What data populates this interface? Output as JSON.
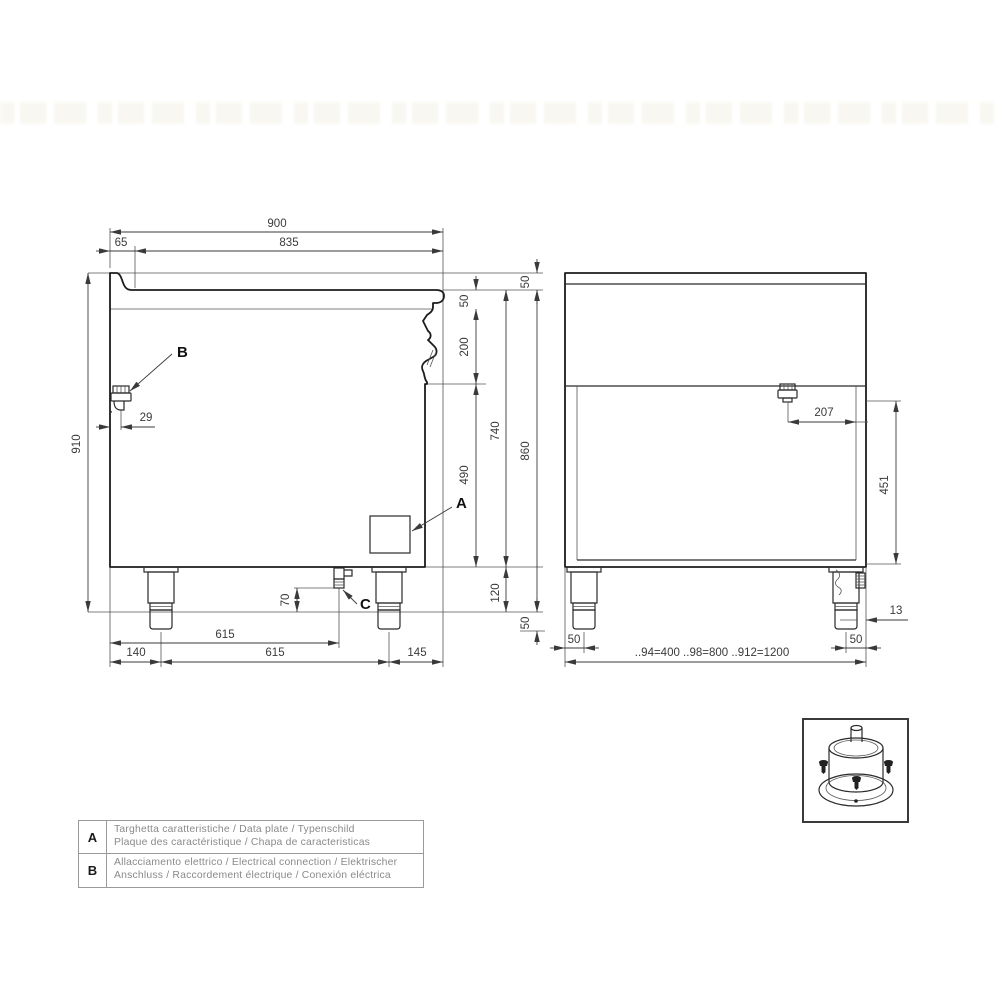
{
  "colors": {
    "background": "#ffffff",
    "line": "#1c1c1c",
    "dim_text": "#3a3a3a",
    "legend_text": "#8a8a8a"
  },
  "side_view": {
    "labels": {
      "data_plate": "A",
      "electrical_gland": "B",
      "drain": "C"
    },
    "dims": {
      "total_width": "900",
      "top_width": "835",
      "left_edge": "65",
      "splash_height": "50",
      "counter_edge": "50",
      "panel_height": "200",
      "body_height": "490",
      "under_top_height": "740",
      "work_height": "860",
      "foot_height": "120",
      "foot_adjust": "50",
      "total_height": "910",
      "gland_offset": "29",
      "drain_height": "70",
      "drain_offset": "615",
      "foot_offset_left": "140",
      "feet_span": "615",
      "foot_offset_right": "145"
    }
  },
  "rear_view": {
    "dims": {
      "gland_offset": "207",
      "gland_height": "451",
      "thread_width": "13",
      "foot_inset_left": "50",
      "foot_inset_right": "50",
      "width_note": "..94=400 ..98=800 ..912=1200"
    }
  },
  "legend": {
    "rows": [
      {
        "key": "A",
        "line1": "Targhetta caratteristiche / Data plate / Typenschild",
        "line2": "Plaque des caractéristique / Chapa de caracteristicas"
      },
      {
        "key": "B",
        "line1": "Allacciamento elettrico / Electrical connection / Elektrischer",
        "line2": "Anschluss / Raccordement électrique / Conexión eléctrica"
      }
    ]
  }
}
